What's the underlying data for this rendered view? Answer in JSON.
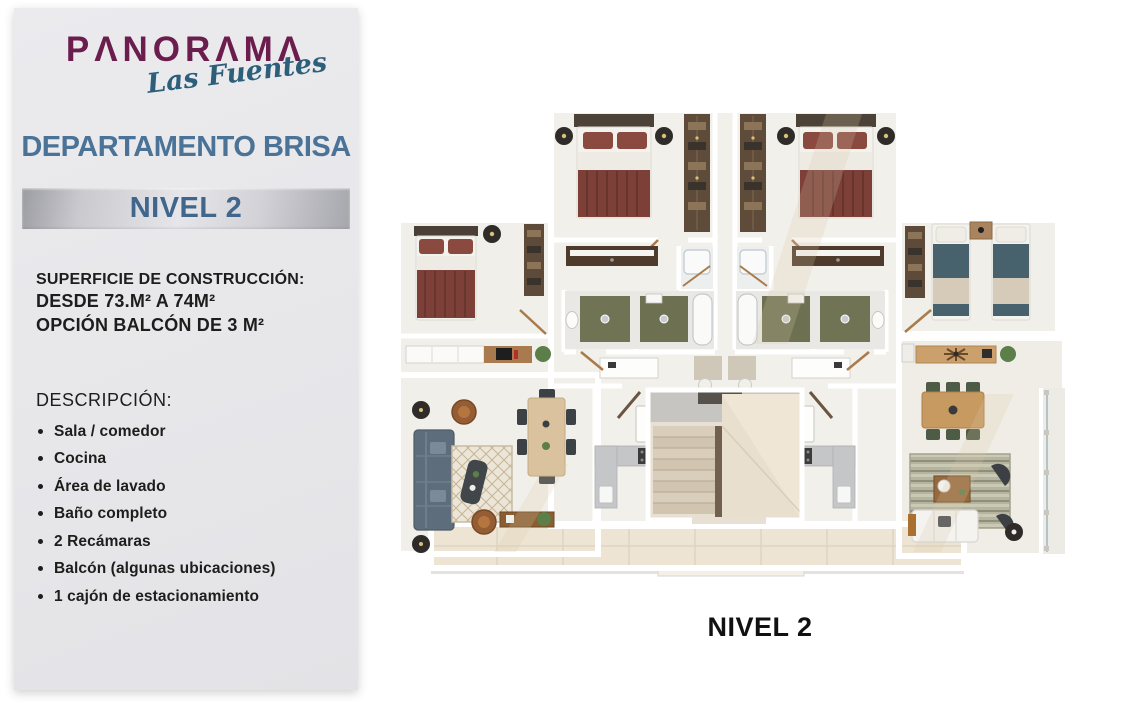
{
  "brand": {
    "name": "PANORAMA",
    "name_display": "PΛNORΛMΛ",
    "tagline": "Las Fuentes",
    "colors": {
      "purple": "#6b1e4e",
      "teal": "#2d5f7b"
    }
  },
  "apartment": {
    "title": "DEPARTAMENTO BRISA",
    "level_badge": "NIVEL 2",
    "surface": {
      "heading": "SUPERFICIE DE CONSTRUCCIÓN:",
      "line1": "DESDE 73.M² A 74M²",
      "line2": "OPCIÓN BALCÓN DE 3 M²"
    },
    "description": {
      "heading": "DESCRIPCIÓN:",
      "items": [
        "Sala / comedor",
        "Cocina",
        "Área de lavado",
        "Baño completo",
        "2 Recámaras",
        "Balcón (algunas ubicaciones)",
        "1 cajón de estacionamiento"
      ]
    }
  },
  "plan": {
    "caption": "NIVEL 2"
  },
  "palette": {
    "title_blue": "#4a7397",
    "banner_text_blue": "#40668c",
    "body_text": "#1d1d1b",
    "bed_maroon": "#7c4038",
    "bed_teal": "#47626d",
    "bath_green": "#707455"
  }
}
